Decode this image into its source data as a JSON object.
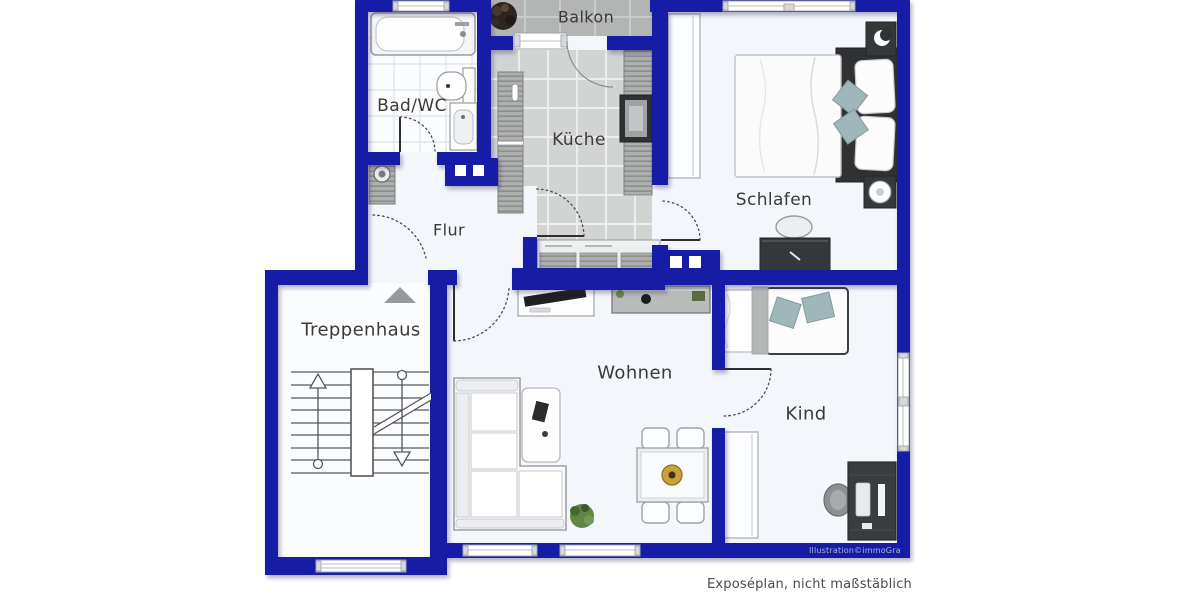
{
  "rooms": {
    "balkon": "Balkon",
    "bad": "Bad/WC",
    "kueche": "Küche",
    "schlafen": "Schlafen",
    "flur": "Flur",
    "treppenhaus": "Treppenhaus",
    "wohnen": "Wohnen",
    "kind": "Kind"
  },
  "footer": {
    "note": "Exposéplan, nicht maßstäblich",
    "credit": "Illustration©immoGrafik"
  },
  "colors": {
    "wall": "#171ba6",
    "kitchen_floor": "#d2d4d3",
    "balcony_floor": "#b3b5b4",
    "accent_pillow": "#9fb6ba"
  }
}
